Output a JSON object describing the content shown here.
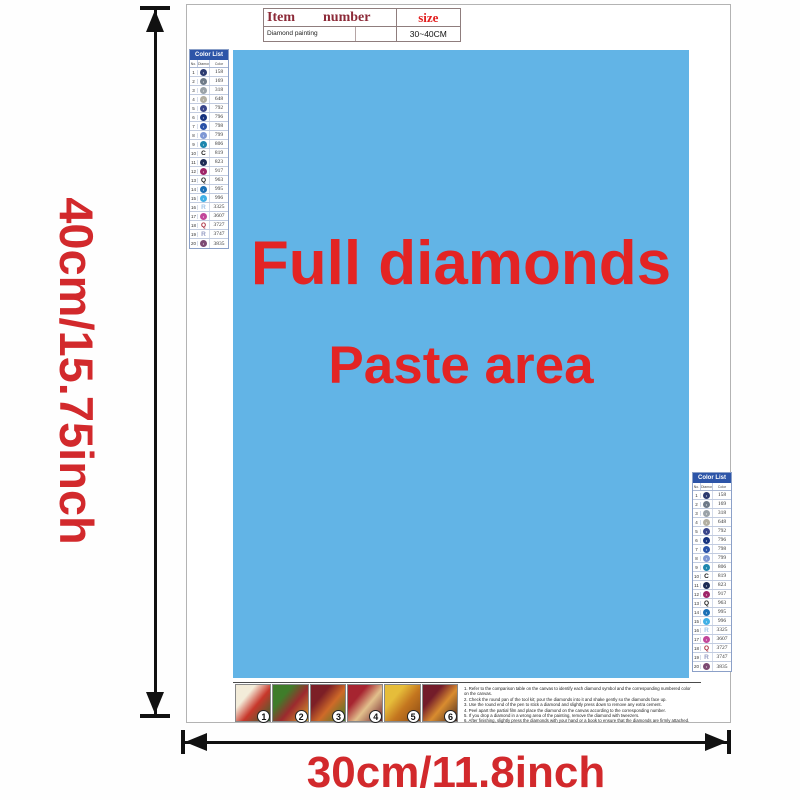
{
  "dimensions": {
    "height_label": "40cm/15.75inch",
    "width_label": "30cm/11.8inch"
  },
  "info_table": {
    "header_item": "Item",
    "header_number": "number",
    "header_size": "size",
    "cell_item": "Diamond painting",
    "cell_number": "",
    "cell_size": "30~40CM"
  },
  "paste_area": {
    "line1": "Full diamonds",
    "line2": "Paste area"
  },
  "color_list": {
    "title": "Color List",
    "columns": [
      "No.",
      "Diamond",
      "Color"
    ],
    "rows": [
      {
        "no": "1",
        "type": "circle",
        "hex": "#2b3a70",
        "mark": "•",
        "code": "158"
      },
      {
        "no": "2",
        "type": "circle",
        "hex": "#6e7a88",
        "mark": "•",
        "code": "169"
      },
      {
        "no": "3",
        "type": "circle",
        "hex": "#9aa2a8",
        "mark": "•",
        "code": "318"
      },
      {
        "no": "4",
        "type": "circle",
        "hex": "#b3afa2",
        "mark": "•",
        "code": "648"
      },
      {
        "no": "5",
        "type": "circle",
        "hex": "#39458a",
        "mark": "•",
        "code": "792"
      },
      {
        "no": "6",
        "type": "circle",
        "hex": "#17337f",
        "mark": "•",
        "code": "796"
      },
      {
        "no": "7",
        "type": "circle",
        "hex": "#2a52a8",
        "mark": "•",
        "code": "798"
      },
      {
        "no": "8",
        "type": "circle",
        "hex": "#7e97d4",
        "mark": "•",
        "code": "799"
      },
      {
        "no": "9",
        "type": "circle",
        "hex": "#1d86ae",
        "mark": "•",
        "code": "806"
      },
      {
        "no": "10",
        "type": "letter",
        "hex": "#1a1a1a",
        "mark": "C",
        "code": "819"
      },
      {
        "no": "11",
        "type": "circle",
        "hex": "#1c2b55",
        "mark": "•",
        "code": "823"
      },
      {
        "no": "12",
        "type": "circle",
        "hex": "#9e2468",
        "mark": "•",
        "code": "917"
      },
      {
        "no": "13",
        "type": "letter",
        "hex": "#1a1a1a",
        "mark": "Q",
        "code": "963"
      },
      {
        "no": "14",
        "type": "circle",
        "hex": "#1b6fb5",
        "mark": "•",
        "code": "995"
      },
      {
        "no": "15",
        "type": "circle",
        "hex": "#41b0e6",
        "mark": "•",
        "code": "996"
      },
      {
        "no": "16",
        "type": "letter",
        "hex": "#9fc4e8",
        "mark": "R",
        "code": "3325"
      },
      {
        "no": "17",
        "type": "circle",
        "hex": "#c2479a",
        "mark": "•",
        "code": "3607"
      },
      {
        "no": "18",
        "type": "letter",
        "hex": "#a82a3c",
        "mark": "Q",
        "code": "3727"
      },
      {
        "no": "19",
        "type": "letter",
        "hex": "#959cc2",
        "mark": "R",
        "code": "3747"
      },
      {
        "no": "20",
        "type": "circle",
        "hex": "#7c4a72",
        "mark": "•",
        "code": "3835"
      }
    ]
  },
  "steps": [
    {
      "num": "1",
      "colors": [
        "#f3ecd9",
        "#c8372b",
        "#31662f"
      ]
    },
    {
      "num": "2",
      "colors": [
        "#3f7c2a",
        "#9c2a2e",
        "#d9a32c"
      ]
    },
    {
      "num": "3",
      "colors": [
        "#7c1f26",
        "#cf6a28",
        "#3f7c2a"
      ]
    },
    {
      "num": "4",
      "colors": [
        "#a62430",
        "#e2c08c",
        "#6e1f2a"
      ]
    },
    {
      "num": "5",
      "colors": [
        "#e6bd3a",
        "#c4761f",
        "#8a4a14"
      ]
    },
    {
      "num": "6",
      "colors": [
        "#731c2a",
        "#d98c2f",
        "#4a2c22"
      ]
    }
  ],
  "instructions": {
    "lines": [
      "1. Refer to the comparison table on the canvas to identify each diamond symbol and the corresponding numbered color on the canvas.",
      "2. Check the round pan of the tool kit; pour the diamonds into it and shake gently so the diamonds face up.",
      "3. Use the round end of the pen to stick a diamond and slightly press down to remove any extra cement.",
      "4. Peel apart the partial film and place the diamond on the canvas according to the corresponding number.",
      "5. If you drop a diamond in a wrong area of the painting, remove the diamond with tweezers.",
      "6. After finishing, slightly press the diamonds with your hand or a book to ensure that the diamonds are firmly attached."
    ]
  },
  "colors": {
    "accent_red": "#d2292c",
    "paste_blue": "#62b4e6",
    "list_header_blue": "#2d55a8",
    "arrow_black": "#111111"
  }
}
